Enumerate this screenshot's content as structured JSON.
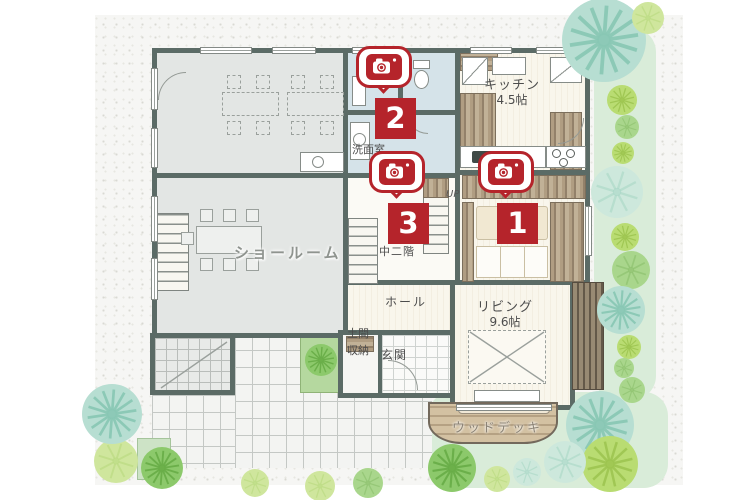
{
  "plan": {
    "labels": {
      "showroom": "ショールーム",
      "kitchen": "キッチン",
      "kitchen_size": "4.5帖",
      "washroom": "洗面室",
      "mezzanine": "中二階",
      "stairs_up": "UP",
      "hall": "ホール",
      "doma_line1": "土間",
      "doma_line2": "収納",
      "entrance": "玄関",
      "living": "リビング",
      "living_size": "9.6帖",
      "wood_deck": "ウッドデッキ"
    },
    "photo_markers": [
      {
        "number": "1"
      },
      {
        "number": "2"
      },
      {
        "number": "3"
      }
    ],
    "colors": {
      "marker_red": "#b5242b",
      "wall": "#5b6b66",
      "room_gray": "#e3e6e4",
      "floor_cream": "#f8f4ea",
      "wet_room_blue": "#d5e3e9",
      "garden_green": "#d9ecd9"
    }
  }
}
